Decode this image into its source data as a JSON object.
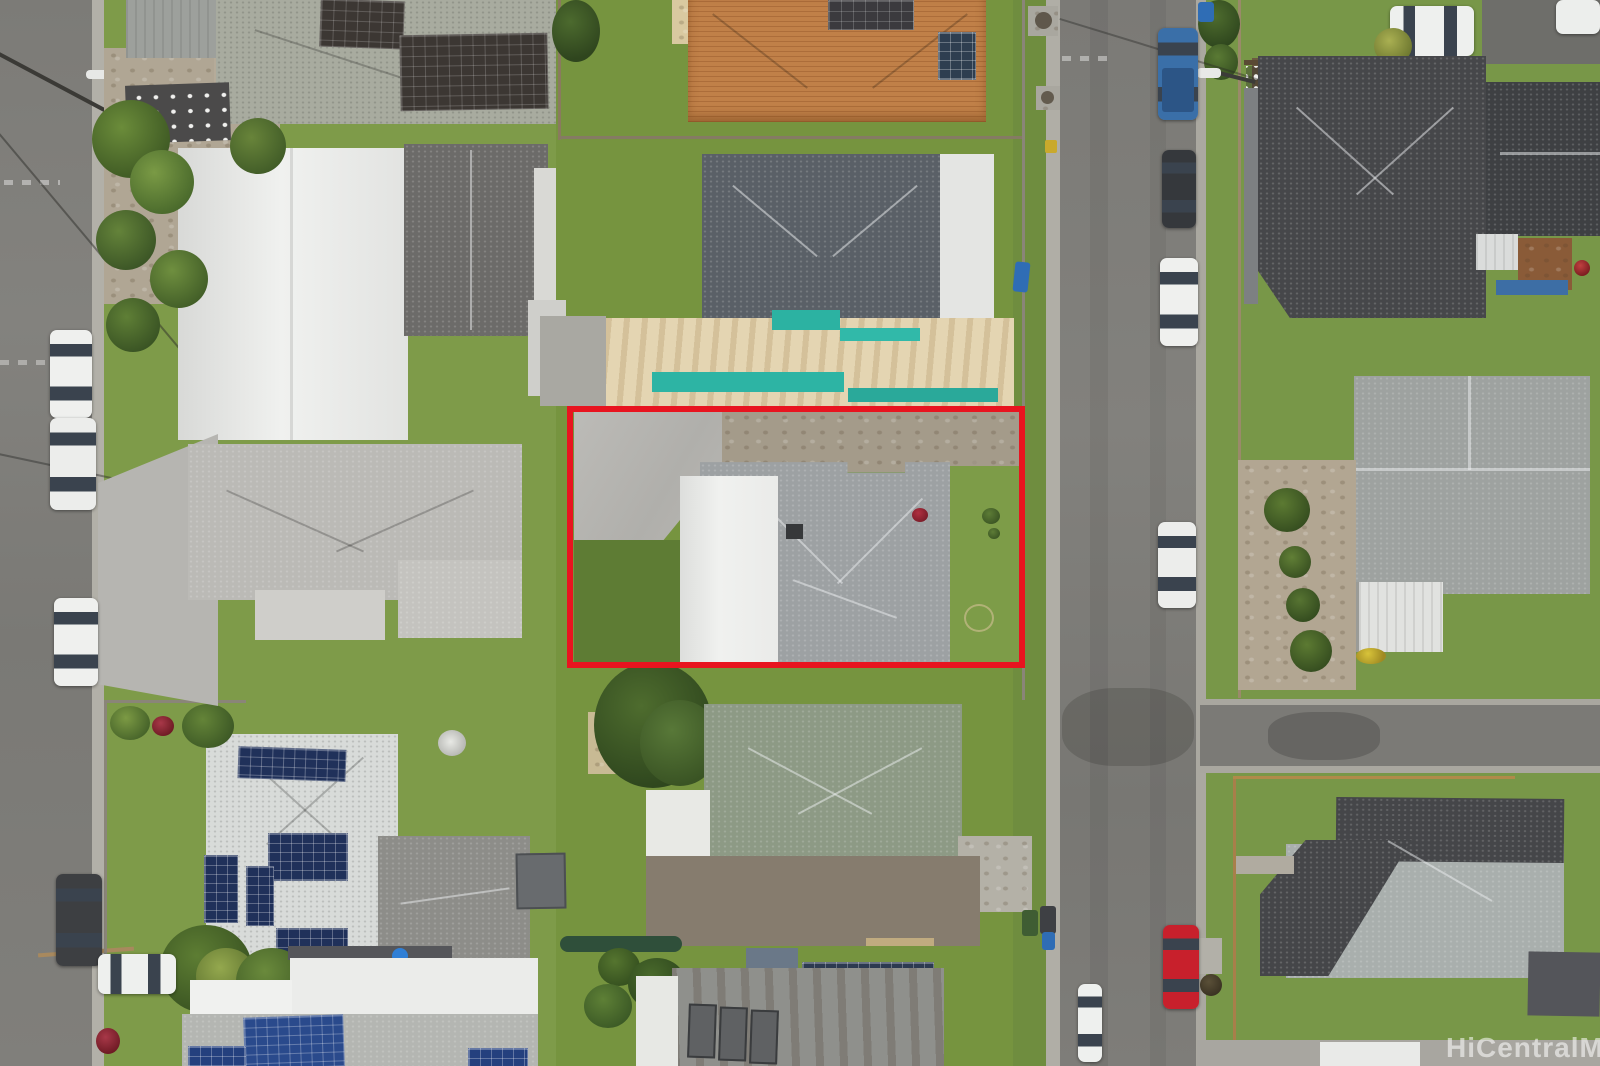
{
  "watermark": {
    "text": "HiCentralMLS"
  },
  "colors": {
    "boundary_red": "#e8141f",
    "asphalt": "#7b7a76",
    "curb_concrete": "#b0aea6",
    "grass_base": "#7f9c4b",
    "teal_trim": "#2cb2a2",
    "plywood_deck": "#e4d5b2",
    "orange_tile_roof": "#c08048",
    "sage_roof": "#8d9a85",
    "charcoal_roof": "#46474a",
    "white_roof": "#ebecea",
    "solar_blue": "#20315a"
  },
  "scene": {
    "type": "aerial-drone-photo",
    "description": "Overhead view of a residential block; one lot outlined in red for a real-estate listing",
    "subject_property": {
      "outline_color": "#e8141f",
      "features": [
        "gray shingle hip roof",
        "white garage roof",
        "concrete driveway",
        "front and back lawn"
      ]
    },
    "roads": [
      {
        "id": "left-street",
        "orientation": "vertical",
        "position": "left edge"
      },
      {
        "id": "right-street",
        "orientation": "vertical",
        "position": "right of subject block"
      },
      {
        "id": "cross-street",
        "orientation": "horizontal",
        "position": "right block, lower third"
      }
    ],
    "vehicles": [
      {
        "color": "white",
        "location": "left street, upper"
      },
      {
        "color": "white",
        "location": "left street, upper-middle"
      },
      {
        "color": "white",
        "location": "left street, middle"
      },
      {
        "color": "dark-gray",
        "location": "left street, lower"
      },
      {
        "color": "white",
        "location": "bottom-left driveway"
      },
      {
        "color": "blue",
        "type": "pickup",
        "location": "right street, top"
      },
      {
        "color": "black",
        "location": "right street, upper"
      },
      {
        "color": "white",
        "location": "right street, upper-middle"
      },
      {
        "color": "white",
        "location": "right street, middle"
      },
      {
        "color": "red",
        "location": "right street, lower"
      },
      {
        "color": "white",
        "location": "right street left edge, bottom"
      },
      {
        "color": "white",
        "type": "suv",
        "location": "top-right driveway"
      }
    ],
    "details": [
      "rooftop solar arrays",
      "palm trees",
      "trash bins",
      "utility poles and wires",
      "round shrubs in gravel courtyard"
    ]
  }
}
